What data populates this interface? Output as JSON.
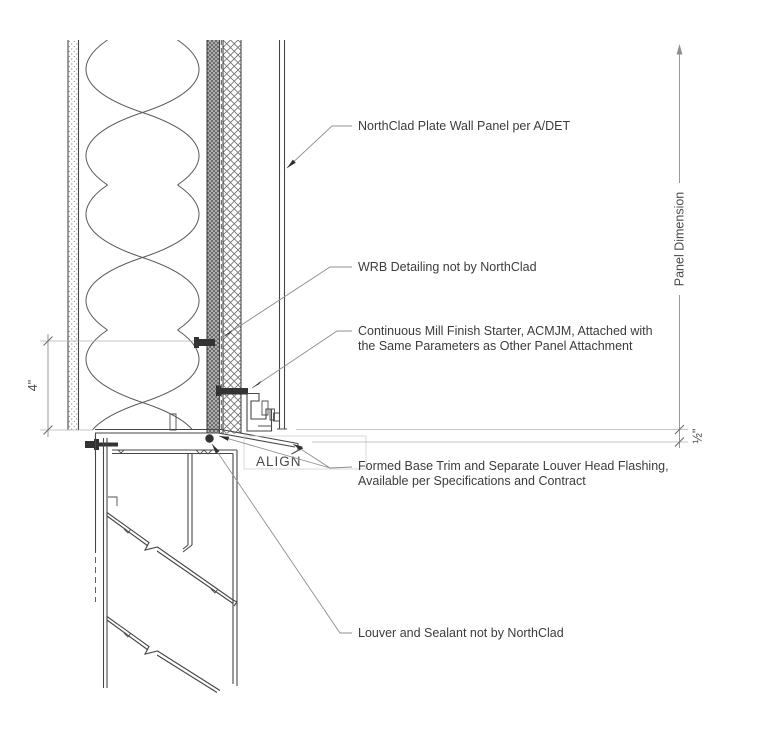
{
  "drawing": {
    "annotations": {
      "panel": "NorthClad Plate Wall Panel per A/DET",
      "wrb": "WRB Detailing not by NorthClad",
      "starter_1": "Continuous Mill Finish Starter, ACMJM, Attached with",
      "starter_2": "the Same Parameters as Other Panel Attachment",
      "base_trim_1": "Formed Base Trim and Separate Louver Head Flashing,",
      "base_trim_2": "Available per Specifications and Contract",
      "louver": "Louver and Sealant not by NorthClad",
      "align": "ALIGN"
    },
    "dimensions": {
      "stud_offset": "4\"",
      "panel": "Panel Dimension",
      "joint": "½\""
    },
    "colors": {
      "linework": "#464646",
      "leader": "#8f8f8f",
      "text": "#3c3c3c",
      "background": "#ffffff"
    }
  }
}
